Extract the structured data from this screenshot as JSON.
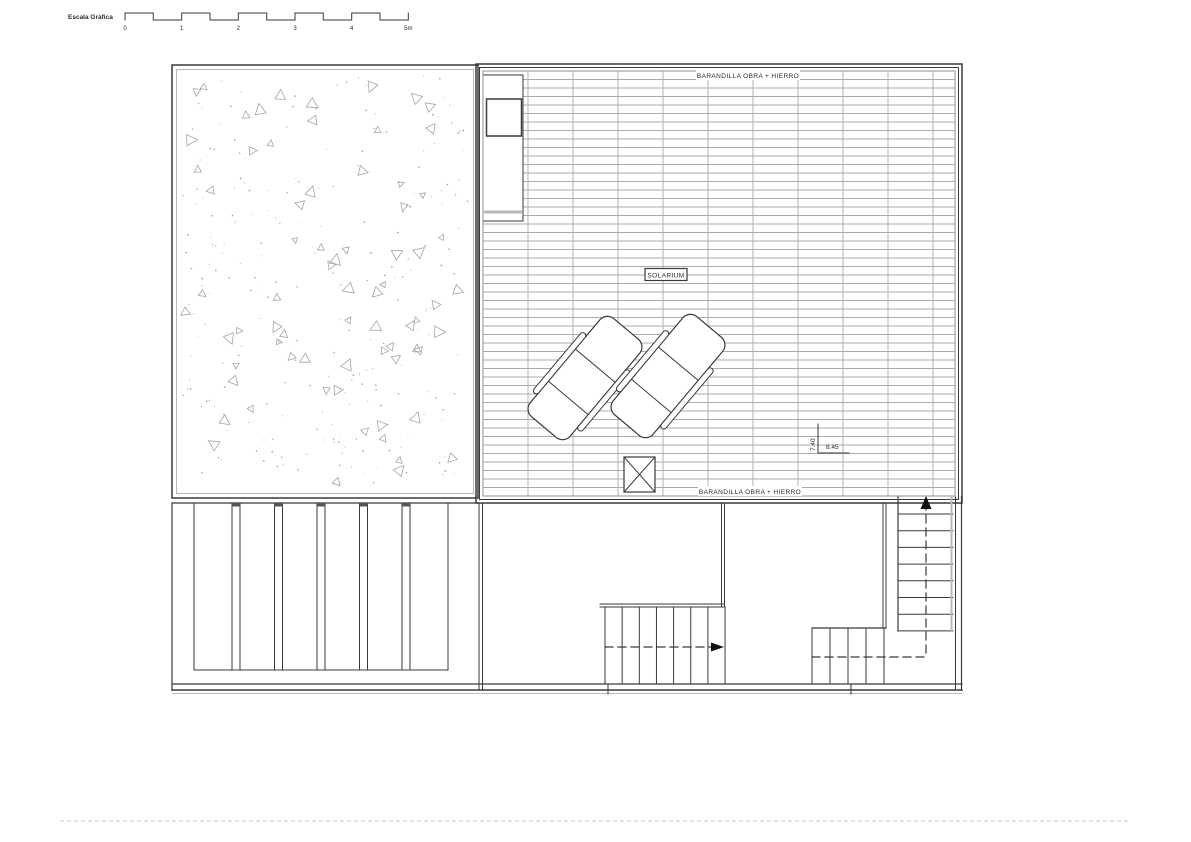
{
  "scale_bar": {
    "label": "Escala Gráfica",
    "ticks": [
      "0",
      "1",
      "2",
      "3",
      "4",
      "5m"
    ]
  },
  "solarium": {
    "label": "SOLARIUM",
    "railing_label_top": "BARANDILLA OBRA + HIERRO",
    "railing_label_bottom": "BARANDILLA OBRA + HIERRO"
  },
  "dimensions": {
    "height_label": "7.40",
    "width_label": "8.45"
  },
  "colors": {
    "line_dark": "#3a3a3a",
    "line_gray": "#b8b8b8",
    "deck_line": "#8f8f8f",
    "deck_joint": "#ababab",
    "speckle": "#a5a5a5",
    "faint_note": "#dcdcdc"
  }
}
